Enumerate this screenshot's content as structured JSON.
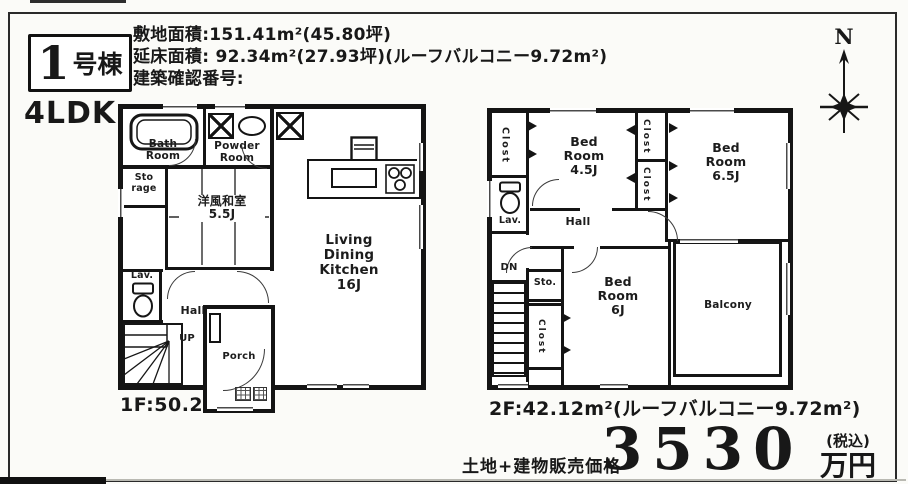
{
  "building": {
    "number": "1",
    "suffix": "号棟",
    "layout": "4LDK"
  },
  "site_info": {
    "line1": "敷地面積:151.41m²(45.80坪)",
    "line2": "延床面積: 92.34m²(27.93坪)(ルーフバルコニー9.72m²)",
    "line3": "建築確認番号:"
  },
  "compass": {
    "north": "N"
  },
  "floor1": {
    "area_label": "1F:50.22m²",
    "rooms": {
      "bath": "Bath\nRoom",
      "powder": "Powder\nRoom",
      "storage": "Sto\nrage",
      "japanese_room": "洋風和室\n5.5J",
      "ldk": "Living\nDining\nKitchen\n16J",
      "lav": "Lav.",
      "hall": "Hall",
      "up": "UP",
      "porch": "Porch"
    }
  },
  "floor2": {
    "area_label": "2F:42.12m²(ルーフバルコニー9.72m²)",
    "rooms": {
      "closet_nw": "Clost",
      "bed_45": "Bed\nRoom\n4.5J",
      "closet_c1": "Clost",
      "closet_c2": "Clost",
      "bed_65": "Bed\nRoom\n6.5J",
      "lav": "Lav.",
      "hall": "Hall",
      "dn": "DN",
      "sto": "Sto.",
      "closet_sw": "Clost",
      "bed_6": "Bed\nRoom\n6J",
      "balcony": "Balcony"
    }
  },
  "price": {
    "label": "土地+建物販売価格",
    "amount": "3530",
    "tax_note": "(税込)",
    "unit": "万円"
  }
}
